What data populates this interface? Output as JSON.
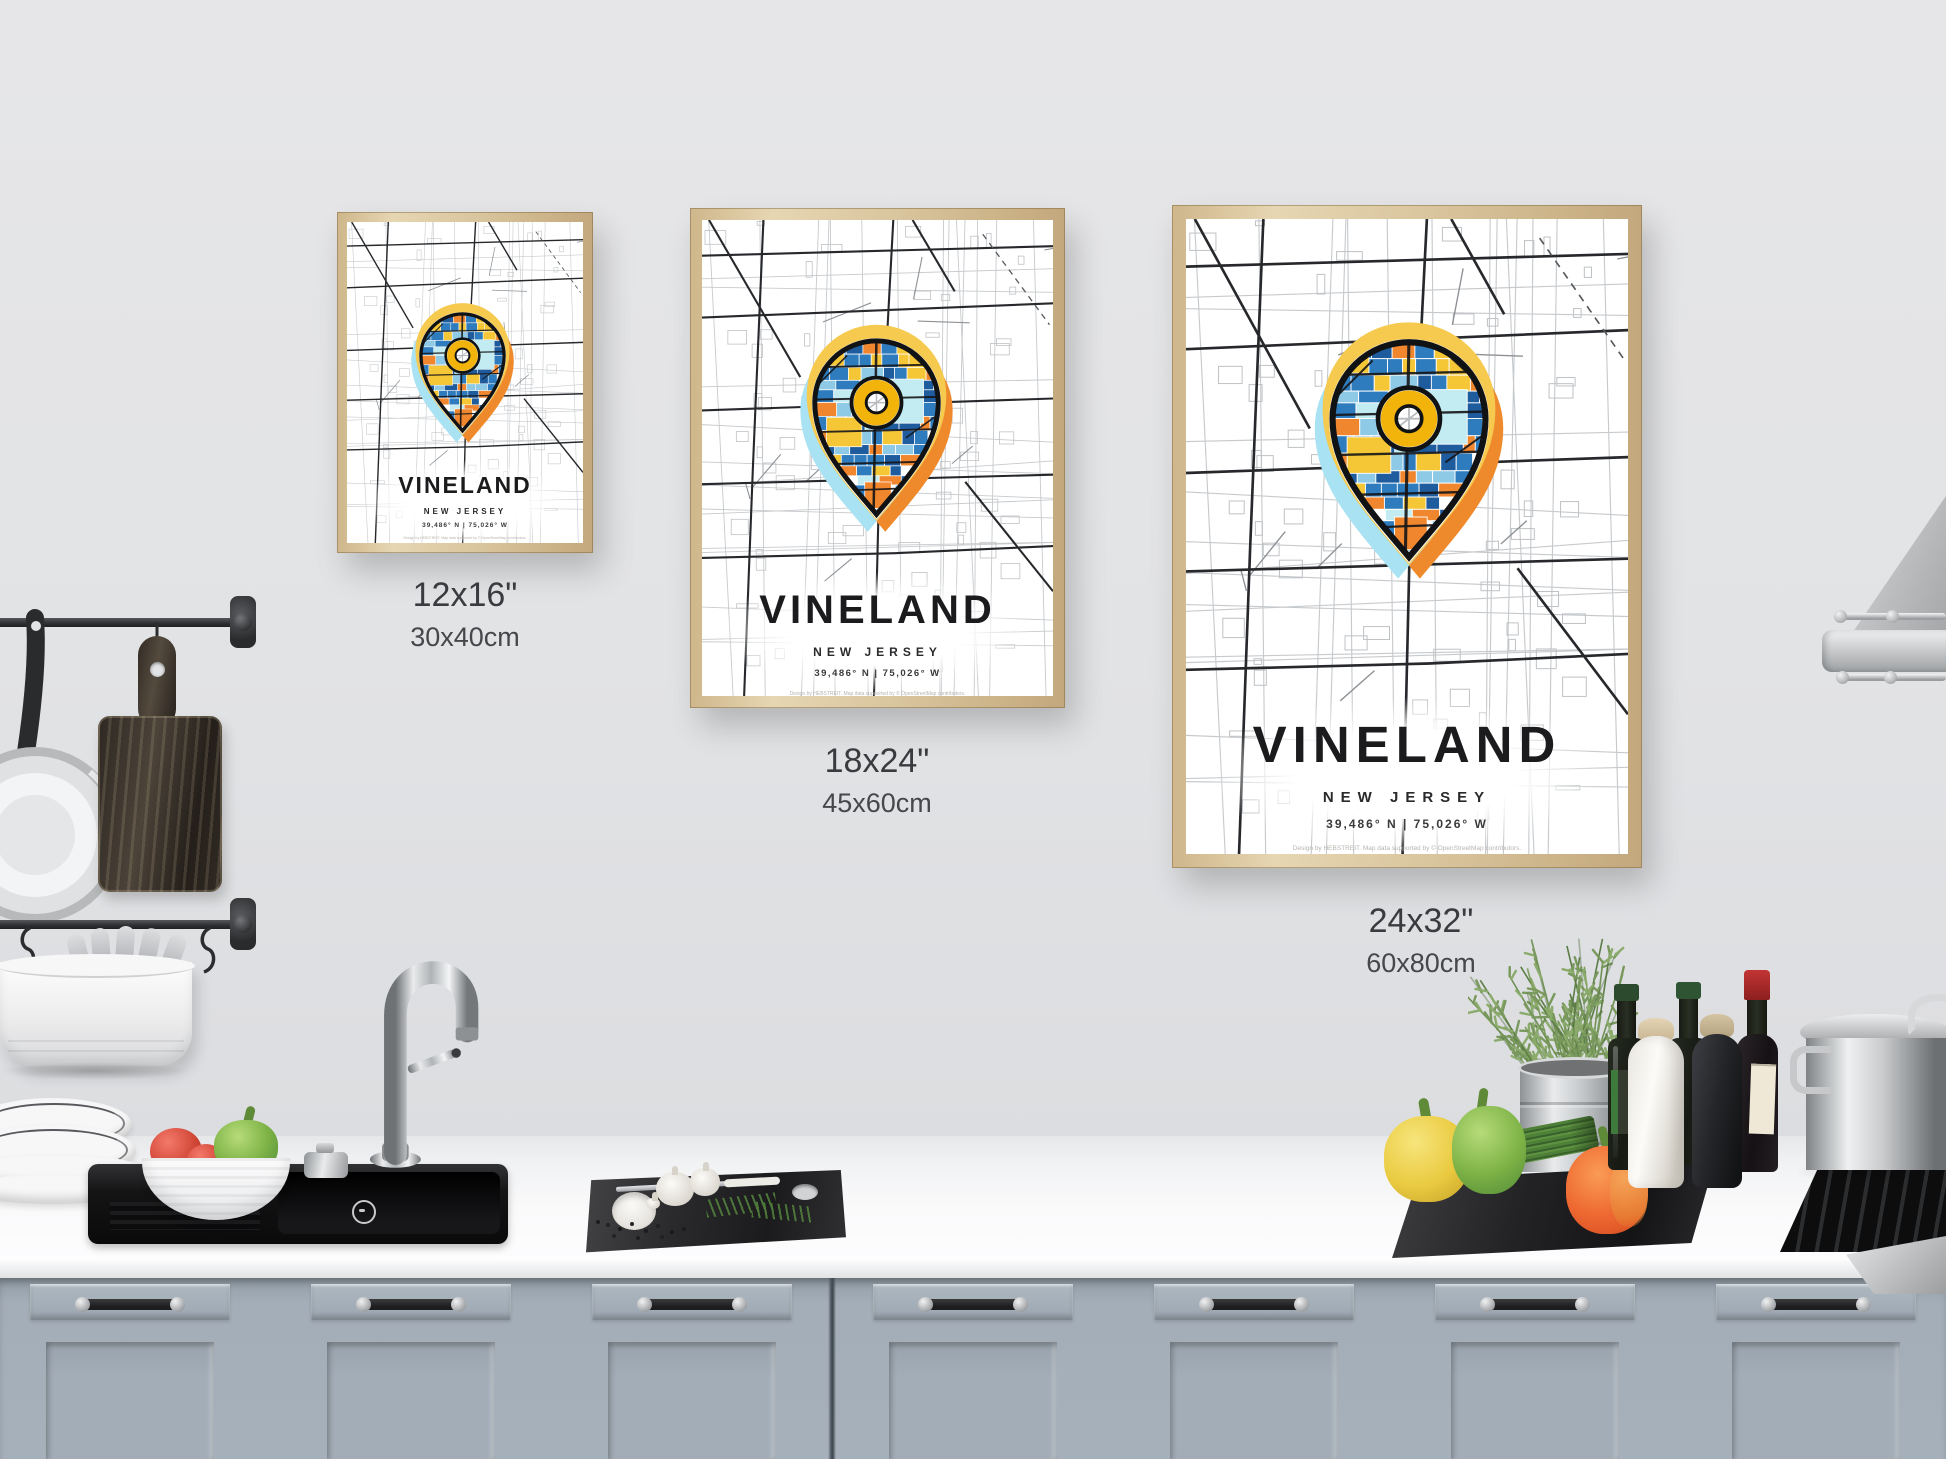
{
  "page": {
    "description": "Kitchen wall mockup with three framed VINELAND New Jersey map posters in three sizes"
  },
  "colors": {
    "wall": "#e3e4e6",
    "counter": "#f6f6f7",
    "cabinet": "#a6b0ba",
    "frameWood": "#d9c59e",
    "roadMajor": "#26282b",
    "roadMid": "#8e9296",
    "roadMinor": "#c7cacd",
    "haloYellow": "#f6c94f",
    "haloCyan": "#a8e2f3",
    "haloOrange": "#ef8a2c",
    "pinBlue": "#2e7cbd",
    "pinBlueDark": "#1e5c9e",
    "pinSky": "#8ecae6",
    "pinCyan": "#c2ecf2",
    "pinYellow": "#f5c636",
    "pinOrange": "#f0862d",
    "ringYellow": "#f2b40a"
  },
  "posters": [
    {
      "title": "VINELAND",
      "state": "NEW JERSEY",
      "coordinates": "39,486° N | 75,026° W",
      "credit": "Design by HEBSTREIT. Map data supported by © OpenStreetMap contributors.",
      "size_inches": "12x16\"",
      "size_cm": "30x40cm"
    },
    {
      "title": "VINELAND",
      "state": "NEW JERSEY",
      "coordinates": "39,486° N | 75,026° W",
      "credit": "Design by HEBSTREIT. Map data supported by © OpenStreetMap contributors.",
      "size_inches": "18x24\"",
      "size_cm": "45x60cm"
    },
    {
      "title": "VINELAND",
      "state": "NEW JERSEY",
      "coordinates": "39,486° N | 75,026° W",
      "credit": "Design by HEBSTREIT. Map data supported by © OpenStreetMap contributors.",
      "size_inches": "24x32\"",
      "size_cm": "60x80cm"
    }
  ]
}
